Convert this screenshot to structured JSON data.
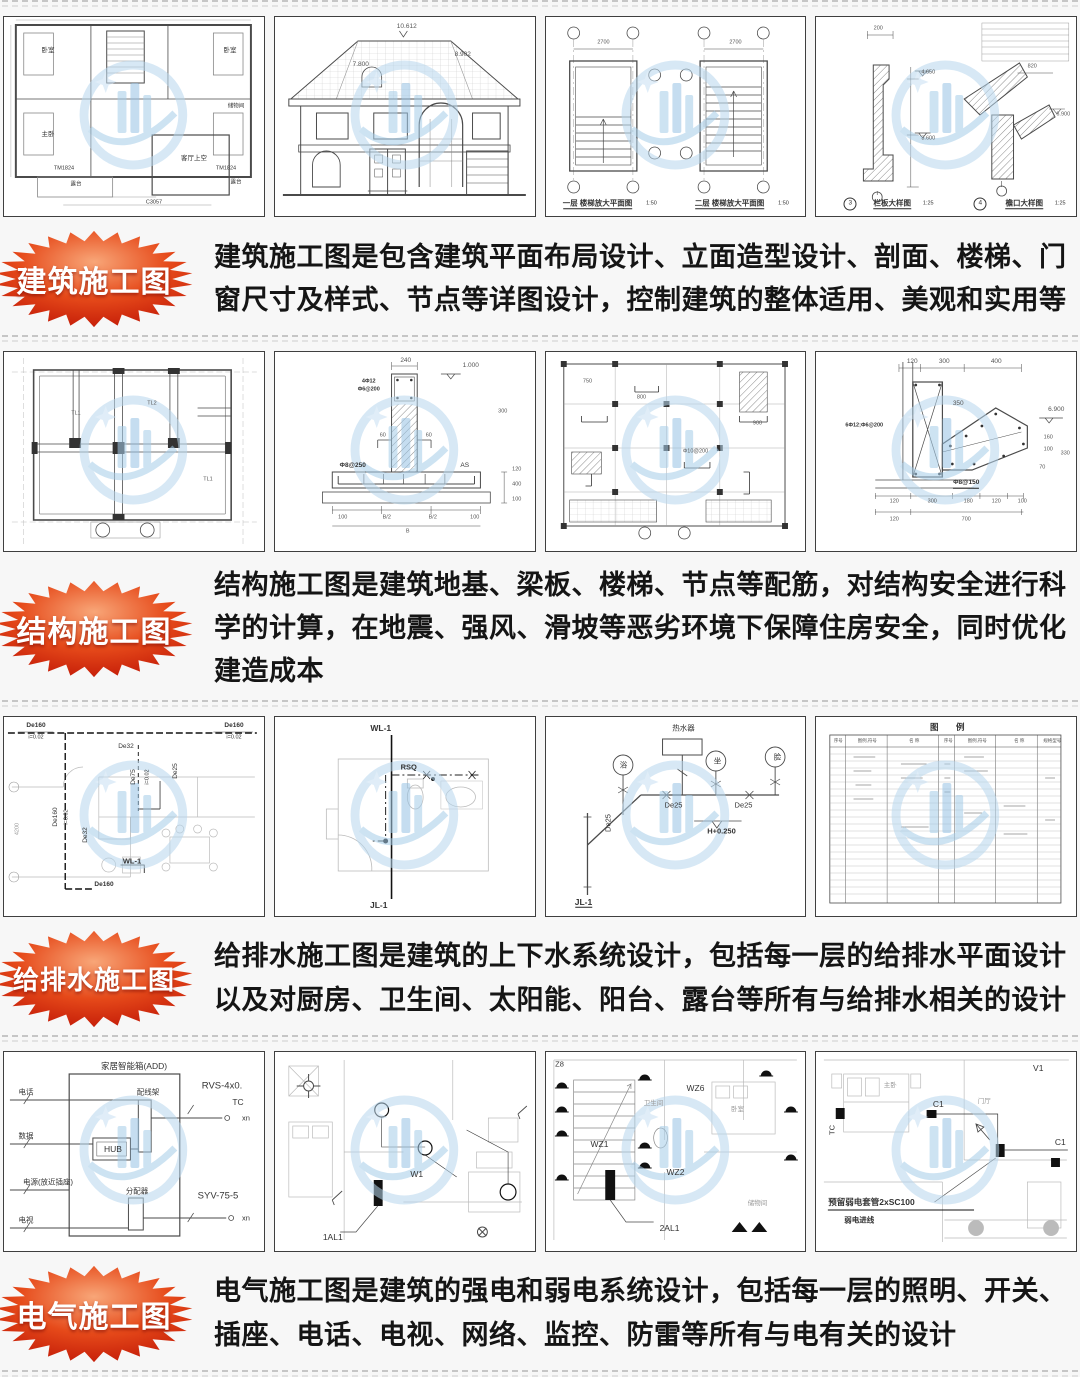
{
  "page": {
    "bg": "#f7f7f7",
    "accent_red": "#d71f04",
    "watermark_blue": "#aed2ec"
  },
  "sections": [
    {
      "id": "architectural",
      "badge": "建筑施工图",
      "description": "建筑施工图是包含建筑平面布局设计、立面造型设计、剖面、楼梯、门窗尺寸及样式、节点等详图设计，控制建筑的整体适用、美观和实用等",
      "thumbs": [
        {
          "name": "second-floor-plan",
          "labels": [
            "卧室",
            "卧室",
            "主卧",
            "储物间",
            "客厅上空",
            "露台",
            "露台",
            "TM1824",
            "TM1824",
            "C3057"
          ]
        },
        {
          "name": "front-elevation",
          "labels": [
            "10.612",
            "8.902",
            "7.800"
          ]
        },
        {
          "name": "stair-enlarged-plans",
          "labels": [
            "一层 楼梯放大平面图",
            "1:50",
            "二层 楼梯放大平面图",
            "1:50",
            "2700",
            "2700"
          ]
        },
        {
          "name": "detail-drawings",
          "labels": [
            "3",
            "栏板大样图",
            "1:25",
            "4",
            "檐口大样图",
            "1:25",
            "4.650",
            "3.600",
            "6.900",
            "820",
            "200"
          ]
        }
      ]
    },
    {
      "id": "structural",
      "badge": "结构施工图",
      "description": "结构施工图是建筑地基、梁板、楼梯、节点等配筋，对结构安全进行科学的计算，在地震、强风、滑坡等恶劣环境下保障住房安全，同时优化建造成本",
      "thumbs": [
        {
          "name": "foundation-plan",
          "labels": [
            "TL1",
            "TL2",
            "TL1"
          ]
        },
        {
          "name": "foundation-detail",
          "labels": [
            "240",
            "1.000",
            "4Φ12",
            "Φ6@200",
            "Φ8@250",
            "AS",
            "60",
            "60",
            "300",
            "400",
            "120",
            "100",
            "100",
            "B/2",
            "B/2",
            "100",
            "B"
          ]
        },
        {
          "name": "slab-reinforcement-plan",
          "labels": [
            "750",
            "800",
            "900",
            "Φ10@200"
          ]
        },
        {
          "name": "cornice-reinforcement-detail",
          "labels": [
            "120",
            "300",
            "400",
            "350",
            "6.900",
            "160",
            "100",
            "330",
            "70",
            "6Φ12;Φ6@200",
            "Φ8@150",
            "120",
            "300",
            "180",
            "120",
            "100",
            "120",
            "700"
          ]
        }
      ]
    },
    {
      "id": "plumbing",
      "badge": "给排水施工图",
      "description": "给排水施工图是建筑的上下水系统设计，包括每一层的给排水平面设计以及对厨房、卫生间、太阳能、阳台、露台等所有与给排水相关的设计",
      "thumbs": [
        {
          "name": "drainage-plan",
          "labels": [
            "De160",
            "i=0.02",
            "De160",
            "i=0.02",
            "De32",
            "De75",
            "i=0.02",
            "De25",
            "De160",
            "i=0.02",
            "De32",
            "4200",
            "WL-1",
            "De160"
          ]
        },
        {
          "name": "bathroom-piping-plan",
          "labels": [
            "WL-1",
            "RSQ",
            "JL-1"
          ]
        },
        {
          "name": "piping-riser-diagram",
          "labels": [
            "热水器",
            "浴",
            "坐",
            "脸",
            "De25",
            "De25",
            "De25",
            "H+0.250",
            "JL-1"
          ]
        },
        {
          "name": "legend-table",
          "labels": [
            "图",
            "例",
            "序号",
            "图例,符号",
            "名 称",
            "序号",
            "图例,符号",
            "名 称",
            "规格型号"
          ]
        }
      ]
    },
    {
      "id": "electrical",
      "badge": "电气施工图",
      "description": "电气施工图是建筑的强电和弱电系统设计，包括每一层的照明、开关、插座、电话、电视、网络、监控、防雷等所有与电有关的设计",
      "thumbs": [
        {
          "name": "smart-home-wiring-diagram",
          "labels": [
            "家居智能箱(ADD)",
            "配线架",
            "HUB",
            "分配器",
            "电话",
            "数据",
            "电源(放近插座)",
            "电视",
            "RVS-4x0.",
            "TC",
            "xn",
            "SYV-75-5",
            "xn"
          ]
        },
        {
          "name": "lighting-plan",
          "labels": [
            "1AL1",
            "W1"
          ]
        },
        {
          "name": "socket-plan",
          "labels": [
            "Z8",
            "WZ1",
            "WZ6",
            "WZ2",
            "2AL1",
            "卫生间",
            "卧室",
            "储物间"
          ]
        },
        {
          "name": "weak-current-plan",
          "labels": [
            "主卧",
            "V1",
            "C1",
            "TC",
            "C1",
            "门厅",
            "预留弱电套管2xSC100",
            "弱电进线"
          ]
        }
      ]
    }
  ]
}
